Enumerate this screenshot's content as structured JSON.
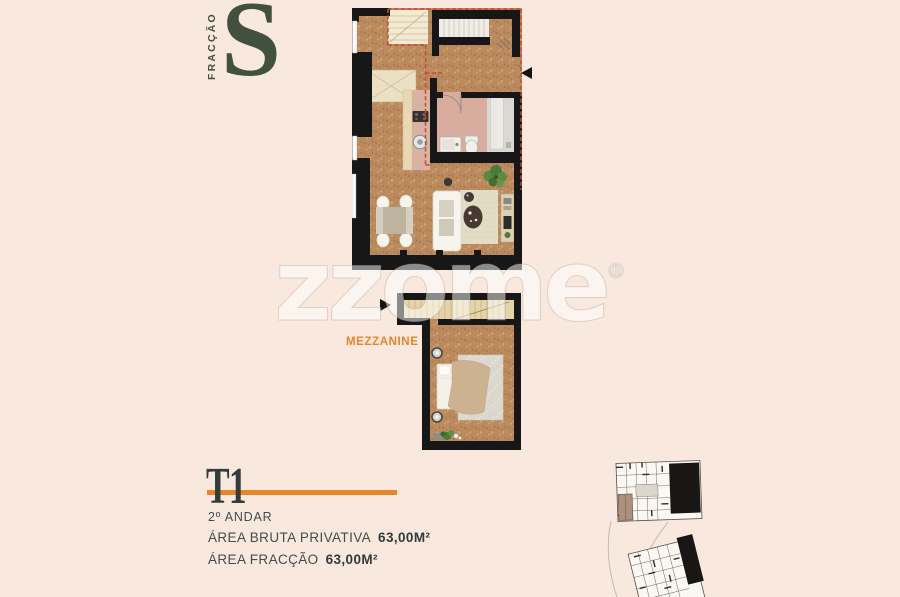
{
  "header": {
    "fraction_label": "FRACÇÃO",
    "fraction_letter": "S"
  },
  "watermark": {
    "text": "zzome",
    "registered_mark": "®"
  },
  "floor_plan": {
    "mezzanine_label": "MEZZANINE",
    "entrance_arrow_icons": [
      "upper-level-entrance-arrow",
      "mezzanine-entrance-arrow"
    ]
  },
  "unit_details": {
    "typology": "T1",
    "floor": "2º ANDAR",
    "gross_private_area_label": "ÁREA BRUTA PRIVATIVA",
    "gross_private_area_value": "63,00M²",
    "fraction_area_label": "ÁREA FRACÇÃO",
    "fraction_area_value": "63,00M²"
  },
  "colors": {
    "background": "#f9e8de",
    "accent_orange": "#e8862a",
    "brand_green": "#44503c",
    "text_dark": "#3c4645",
    "wall_black": "#171717",
    "cork_floor": "#bb8a5e",
    "void_dashed_red": "#c14f30",
    "bathroom_floor": "#d9aca0",
    "counter_beige": "#e9d8b4",
    "plant_green": "#5a8742",
    "keyplan_highlight": "#ad907c"
  }
}
